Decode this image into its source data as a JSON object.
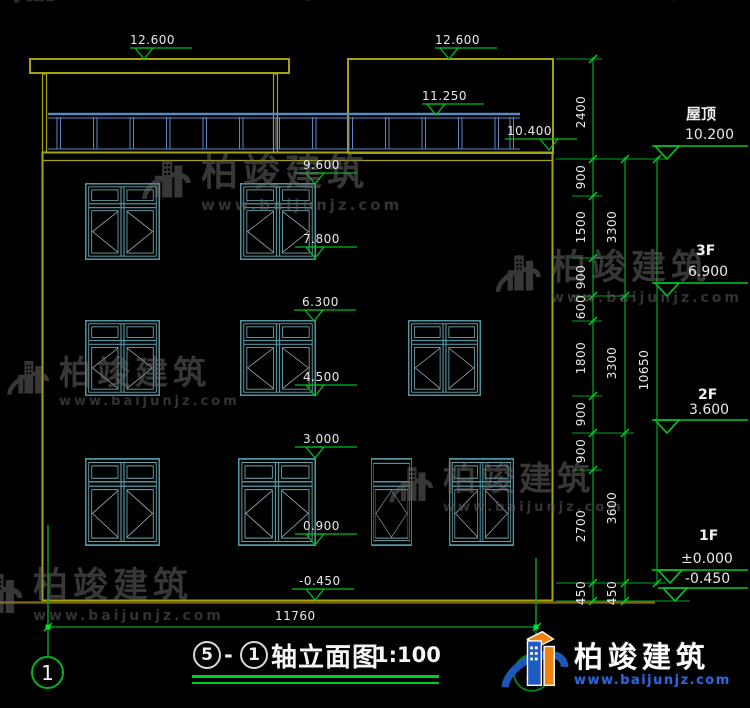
{
  "watermark": {
    "brand": "柏竣建筑",
    "url": "www.baijunjz.com"
  },
  "logo": {
    "brand": "柏竣建筑",
    "url": "www.baijunjz.com"
  },
  "title": {
    "axis_start": "5",
    "separator": "-",
    "axis_end": "1",
    "text": "轴立面图",
    "scale": "1:100"
  },
  "axes": {
    "left_bubble": "1",
    "right_bubble": "5"
  },
  "elevation_markers": {
    "canopy_left": "12.600",
    "canopy_right": "12.600",
    "railing": "11.250",
    "parapet": "10.400",
    "f3_window_top": "9.600",
    "f3_window_bottom": "7.800",
    "f2_window_top": "6.300",
    "f2_window_bottom": "4.500",
    "f1_window_top": "3.000",
    "f1_window_bottom": "0.900",
    "ground": "-0.450"
  },
  "floor_markers": [
    {
      "label": "屋顶",
      "value": "10.200"
    },
    {
      "label": "3F",
      "value": "6.900"
    },
    {
      "label": "2F",
      "value": "3.600"
    },
    {
      "label": "1F",
      "value": "±0.000"
    },
    {
      "label": "",
      "value": "-0.450"
    }
  ],
  "dimensions": {
    "right_inner": [
      "2400",
      "900",
      "1500",
      "900",
      "600",
      "1800",
      "900",
      "900",
      "2700",
      "450"
    ],
    "right_middle": [
      "3300",
      "3300",
      "3600",
      "450"
    ],
    "right_outer": [
      "10650"
    ],
    "bottom_width": "11760"
  }
}
